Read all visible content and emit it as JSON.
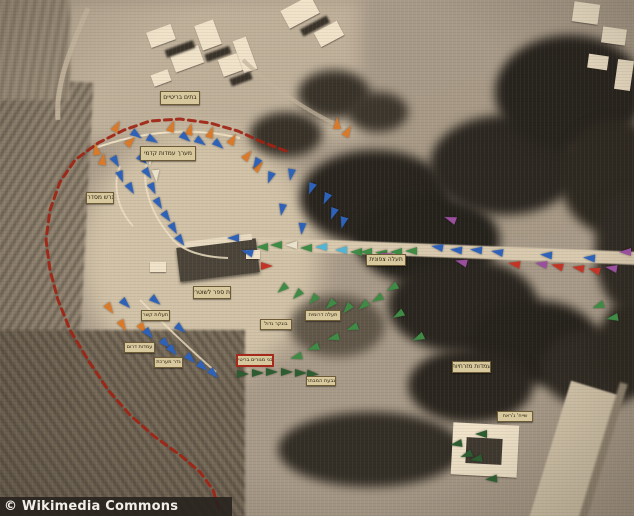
{
  "watermark": {
    "text": "© Wikimedia Commons"
  },
  "map": {
    "description": "Sepia-toned aerial reconnaissance photograph of a fortified hill compound annotated with Hebrew position labels, colored assault arrows and a red dashed perimeter line",
    "perimeter_color": "#a02314",
    "arrow_colors": {
      "b": "#2e62b8",
      "c": "#54b4d4",
      "g": "#3f8a44",
      "d": "#2c5c30",
      "o": "#d9792a",
      "r": "#c23526",
      "p": "#9a4f9e",
      "w": "#e9e1cb"
    },
    "labels": [
      {
        "text": "בתים בריטיים",
        "x": 160,
        "y": 91,
        "w": 38,
        "h": 12,
        "frame": "plain"
      },
      {
        "text": "מערך עמדות קדמי",
        "x": 140,
        "y": 146,
        "w": 54,
        "h": 13,
        "frame": "plain"
      },
      {
        "text": "מגרש מסדרים",
        "x": 86,
        "y": 192,
        "w": 26,
        "h": 10,
        "frame": "plain"
      },
      {
        "text": "בית ספר לשוטרים",
        "x": 193,
        "y": 286,
        "w": 36,
        "h": 11,
        "frame": "plain"
      },
      {
        "text": "בונקר גדול",
        "x": 260,
        "y": 319,
        "w": 30,
        "h": 9,
        "frame": "plain"
      },
      {
        "text": "תעלות קשר",
        "x": 141,
        "y": 310,
        "w": 27,
        "h": 9,
        "frame": "plain"
      },
      {
        "text": "עמדות דרום",
        "x": 124,
        "y": 342,
        "w": 29,
        "h": 9,
        "frame": "plain"
      },
      {
        "text": "גדר מערכת",
        "x": 154,
        "y": 357,
        "w": 27,
        "h": 9,
        "frame": "plain"
      },
      {
        "text": "מבני מגורים בריטיים",
        "x": 237,
        "y": 355,
        "w": 34,
        "h": 9,
        "frame": "red"
      },
      {
        "text": "תעלה דרומית",
        "x": 305,
        "y": 310,
        "w": 34,
        "h": 9,
        "frame": "plain"
      },
      {
        "text": "גבעת המבתר",
        "x": 306,
        "y": 376,
        "w": 28,
        "h": 8,
        "frame": "plain"
      },
      {
        "text": "תעלה צפונית",
        "x": 366,
        "y": 254,
        "w": 38,
        "h": 10,
        "frame": "plain"
      },
      {
        "text": "עמדות מזרחיות",
        "x": 452,
        "y": 361,
        "w": 37,
        "h": 10,
        "frame": "plain"
      },
      {
        "text": "שייח' ג'ראח",
        "x": 497,
        "y": 411,
        "w": 34,
        "h": 9,
        "frame": "plain"
      }
    ],
    "perimeter": [
      [
        286,
        151
      ],
      [
        262,
        142
      ],
      [
        238,
        131
      ],
      [
        210,
        123
      ],
      [
        180,
        119
      ],
      [
        150,
        121
      ],
      [
        124,
        130
      ],
      [
        98,
        143
      ],
      [
        75,
        160
      ],
      [
        60,
        182
      ],
      [
        50,
        210
      ],
      [
        46,
        240
      ],
      [
        50,
        270
      ],
      [
        58,
        300
      ],
      [
        70,
        330
      ],
      [
        88,
        360
      ],
      [
        108,
        390
      ],
      [
        130,
        415
      ],
      [
        155,
        437
      ],
      [
        180,
        455
      ],
      [
        200,
        472
      ],
      [
        213,
        490
      ],
      [
        220,
        512
      ]
    ],
    "arrows": [
      [
        117,
        126,
        -60,
        "o"
      ],
      [
        131,
        141,
        -45,
        "o"
      ],
      [
        96,
        149,
        -100,
        "o"
      ],
      [
        103,
        159,
        -80,
        "o"
      ],
      [
        172,
        126,
        -70,
        "o"
      ],
      [
        190,
        129,
        -75,
        "o"
      ],
      [
        211,
        132,
        -70,
        "o"
      ],
      [
        233,
        139,
        -60,
        "o"
      ],
      [
        248,
        155,
        -50,
        "o"
      ],
      [
        259,
        166,
        -45,
        "o"
      ],
      [
        337,
        123,
        -90,
        "o"
      ],
      [
        348,
        131,
        -60,
        "o"
      ],
      [
        110,
        309,
        55,
        "o"
      ],
      [
        123,
        326,
        60,
        "o"
      ],
      [
        143,
        329,
        55,
        "o"
      ],
      [
        137,
        135,
        35,
        "b"
      ],
      [
        153,
        140,
        30,
        "b"
      ],
      [
        186,
        138,
        40,
        "b"
      ],
      [
        201,
        142,
        35,
        "b"
      ],
      [
        219,
        145,
        40,
        "b"
      ],
      [
        116,
        162,
        60,
        "b"
      ],
      [
        121,
        177,
        70,
        "b"
      ],
      [
        131,
        189,
        60,
        "b"
      ],
      [
        143,
        160,
        45,
        "b"
      ],
      [
        148,
        174,
        55,
        "b"
      ],
      [
        153,
        189,
        65,
        "b"
      ],
      [
        159,
        204,
        60,
        "b"
      ],
      [
        167,
        217,
        55,
        "b"
      ],
      [
        174,
        229,
        60,
        "b"
      ],
      [
        181,
        241,
        55,
        "b"
      ],
      [
        256,
        164,
        120,
        "b"
      ],
      [
        270,
        178,
        110,
        "b"
      ],
      [
        291,
        175,
        100,
        "b"
      ],
      [
        311,
        189,
        110,
        "b"
      ],
      [
        326,
        199,
        115,
        "b"
      ],
      [
        333,
        214,
        110,
        "b"
      ],
      [
        343,
        223,
        105,
        "b"
      ],
      [
        302,
        229,
        95,
        "b"
      ],
      [
        282,
        210,
        100,
        "b"
      ],
      [
        126,
        304,
        45,
        "b"
      ],
      [
        156,
        301,
        40,
        "b"
      ],
      [
        149,
        334,
        50,
        "b"
      ],
      [
        166,
        344,
        45,
        "b"
      ],
      [
        173,
        351,
        50,
        "b"
      ],
      [
        181,
        329,
        40,
        "b"
      ],
      [
        191,
        359,
        45,
        "b"
      ],
      [
        203,
        367,
        40,
        "b"
      ],
      [
        214,
        374,
        45,
        "b"
      ],
      [
        233,
        238,
        180,
        "b"
      ],
      [
        247,
        252,
        195,
        "b"
      ],
      [
        262,
        247,
        180,
        "g"
      ],
      [
        276,
        245,
        180,
        "g"
      ],
      [
        291,
        245,
        180,
        "w"
      ],
      [
        306,
        248,
        180,
        "g"
      ],
      [
        321,
        247,
        180,
        "c"
      ],
      [
        341,
        250,
        180,
        "c"
      ],
      [
        356,
        252,
        180,
        "g"
      ],
      [
        366,
        252,
        180,
        "g"
      ],
      [
        381,
        253,
        185,
        "g"
      ],
      [
        396,
        252,
        180,
        "g"
      ],
      [
        411,
        251,
        180,
        "g"
      ],
      [
        386,
        255,
        200,
        "p"
      ],
      [
        437,
        247,
        190,
        "b"
      ],
      [
        456,
        250,
        185,
        "b"
      ],
      [
        476,
        250,
        185,
        "b"
      ],
      [
        497,
        252,
        190,
        "b"
      ],
      [
        546,
        255,
        185,
        "b"
      ],
      [
        589,
        258,
        185,
        "b"
      ],
      [
        461,
        262,
        195,
        "p"
      ],
      [
        541,
        264,
        190,
        "p"
      ],
      [
        611,
        268,
        190,
        "p"
      ],
      [
        625,
        252,
        180,
        "p"
      ],
      [
        450,
        219,
        200,
        "p"
      ],
      [
        514,
        264,
        190,
        "r"
      ],
      [
        557,
        266,
        195,
        "r"
      ],
      [
        578,
        268,
        190,
        "r"
      ],
      [
        594,
        270,
        195,
        "r"
      ],
      [
        267,
        266,
        0,
        "r"
      ],
      [
        150,
        160,
        90,
        "w"
      ],
      [
        156,
        176,
        85,
        "w"
      ],
      [
        282,
        289,
        140,
        "g"
      ],
      [
        297,
        295,
        135,
        "g"
      ],
      [
        313,
        300,
        130,
        "g"
      ],
      [
        330,
        305,
        135,
        "g"
      ],
      [
        347,
        309,
        130,
        "g"
      ],
      [
        363,
        306,
        140,
        "g"
      ],
      [
        377,
        299,
        150,
        "g"
      ],
      [
        392,
        288,
        150,
        "g"
      ],
      [
        352,
        328,
        160,
        "g"
      ],
      [
        333,
        338,
        165,
        "g"
      ],
      [
        313,
        348,
        160,
        "g"
      ],
      [
        296,
        357,
        165,
        "g"
      ],
      [
        398,
        315,
        150,
        "g"
      ],
      [
        418,
        338,
        155,
        "g"
      ],
      [
        243,
        374,
        0,
        "d"
      ],
      [
        258,
        373,
        0,
        "d"
      ],
      [
        272,
        372,
        0,
        "d"
      ],
      [
        287,
        372,
        0,
        "d"
      ],
      [
        301,
        373,
        0,
        "d"
      ],
      [
        313,
        374,
        5,
        "d"
      ],
      [
        456,
        444,
        170,
        "d"
      ],
      [
        481,
        434,
        180,
        "d"
      ],
      [
        476,
        459,
        170,
        "d"
      ],
      [
        491,
        479,
        175,
        "d"
      ],
      [
        466,
        455,
        160,
        "d"
      ],
      [
        612,
        318,
        170,
        "g"
      ],
      [
        598,
        306,
        160,
        "g"
      ]
    ]
  }
}
